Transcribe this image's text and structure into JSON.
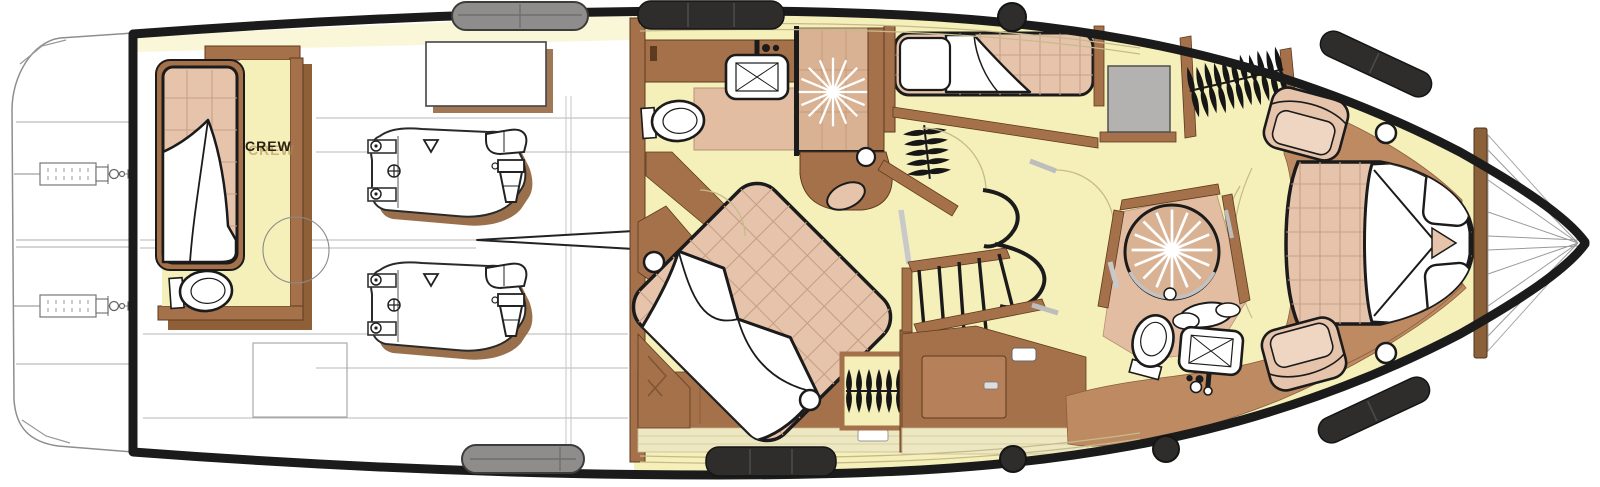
{
  "labels": {
    "crew": "CREW"
  },
  "palette": {
    "floor": "#F5F0B9",
    "wood": "#A5714B",
    "woodlight": "#B5805A",
    "wooddark": "#5E3B1F",
    "woodshadow": "#8F6038",
    "tan": "#E6C4AC",
    "tangrid": "#C7A084",
    "tandeck": "#BE8A62",
    "showertan": "#D9B294",
    "mattan": "#E2BDA2",
    "palecab": "#EDE7C2",
    "white": "#FFFFFF",
    "ink": "#1B1B1B",
    "fender": "#2E2D2B",
    "fendergray": "#8E8D8B",
    "deskgray": "#B3B2B0",
    "linegray": "#9A9A9A",
    "thintan": "#C6BA8C",
    "graybar": "#BDBDBD",
    "textdark": "#2B2013",
    "textghost": "#A78E55"
  },
  "icons": {
    "shower-spray-icon": "white starburst rays",
    "toilet-icon": "oval bowl with cistern",
    "sink-icon": "rounded basin with X and faucet",
    "clothes-hanger-rack-icon": "row of bow-tie hangers on rail",
    "stairs-icon": "fanned treads with curved stringers",
    "porthole-icon": "white circle with black ring",
    "cleat-icon": "black disc",
    "fender-icon": "black capsule on gunwale",
    "engine-icon": "engine line drawing",
    "propeller-shaft-icon": "pointed shaft spear",
    "trim-tab-icon": "stern actuator mechanism",
    "armchair-icon": "rounded armchair top view"
  }
}
